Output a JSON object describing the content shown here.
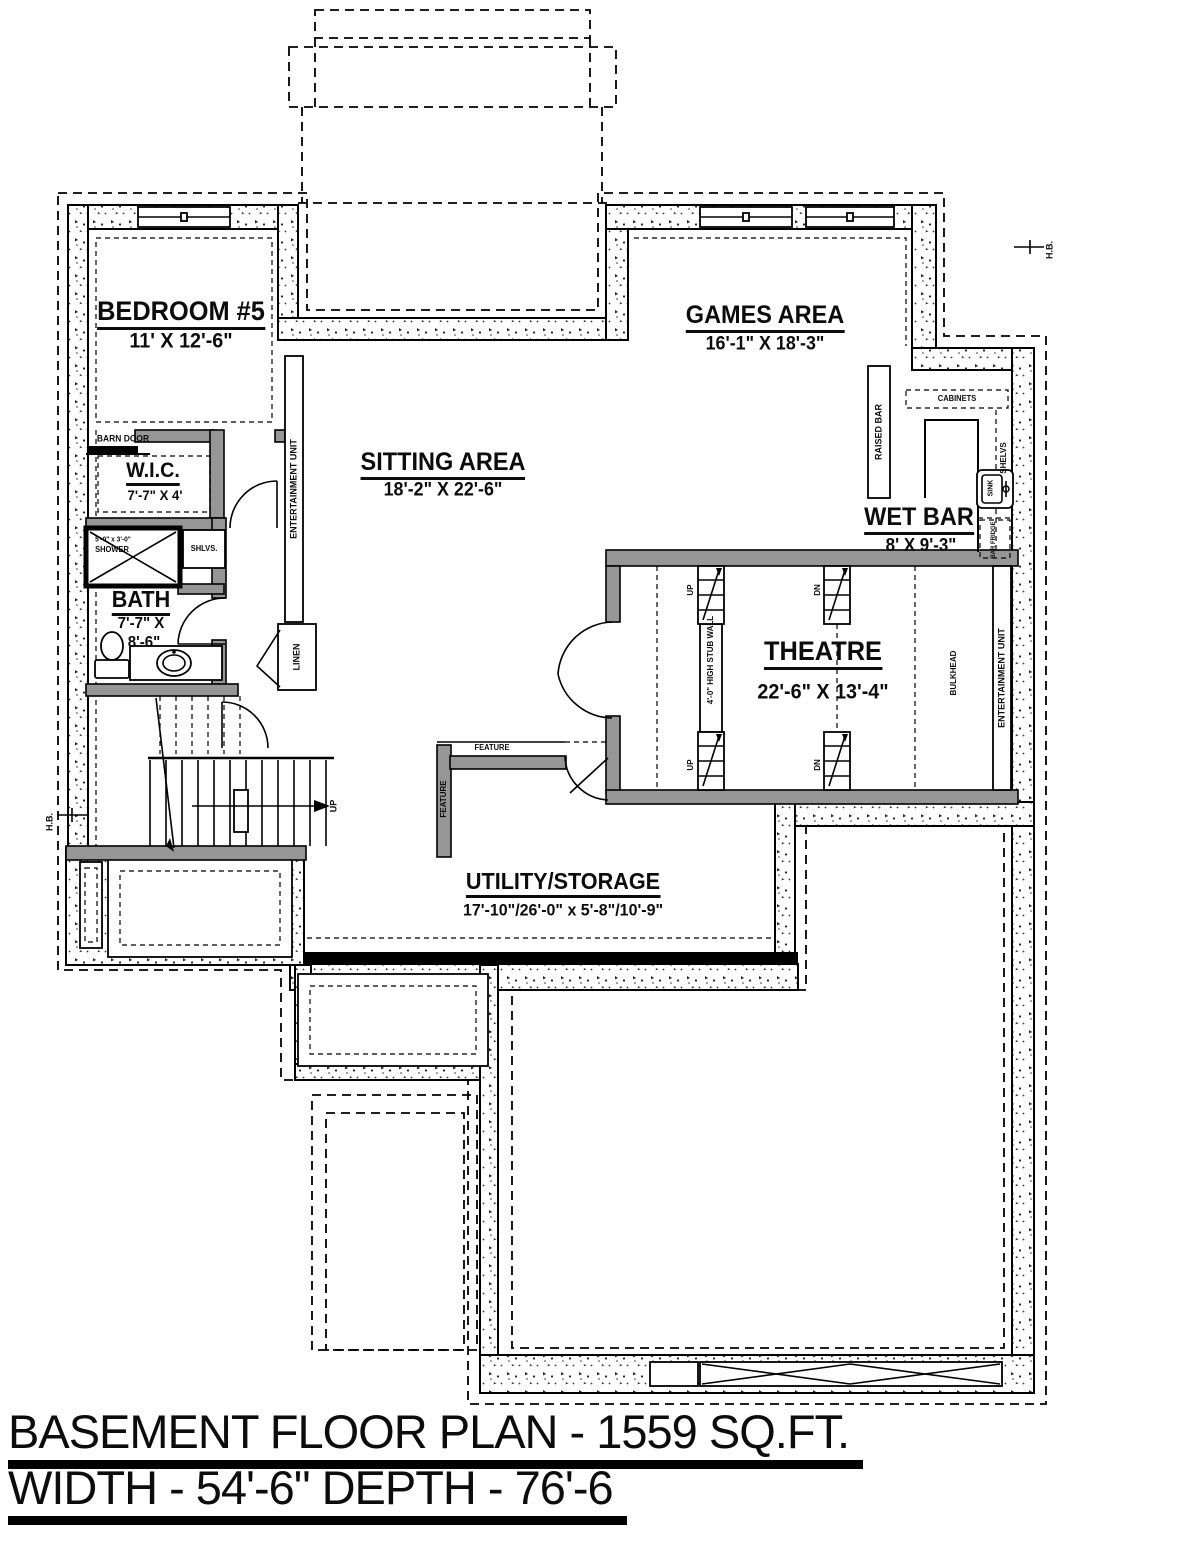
{
  "title_block": {
    "line1": "BASEMENT FLOOR PLAN - 1559 SQ.FT.",
    "line2": "WIDTH - 54'-6\" DEPTH - 76'-6"
  },
  "rooms": {
    "bedroom5": {
      "name": "BEDROOM #5",
      "dims": "11' X 12'-6\""
    },
    "sitting": {
      "name": "SITTING AREA",
      "dims": "18'-2\" X 22'-6\""
    },
    "games": {
      "name": "GAMES AREA",
      "dims": "16'-1\" X 18'-3\""
    },
    "wet_bar": {
      "name": "WET BAR",
      "dims": "8' X 9'-3\""
    },
    "theatre": {
      "name": "THEATRE",
      "dims": "22'-6\" X 13'-4\""
    },
    "wic": {
      "name": "W.I.C.",
      "dims": "7'-7\" X 4'"
    },
    "bath": {
      "name": "BATH",
      "dims_line1": "7'-7\" X",
      "dims_line2": "8'-6\""
    },
    "utility": {
      "name": "UTILITY/STORAGE",
      "dims": "17'-10\"/26'-0\" x 5'-8\"/10'-9\""
    }
  },
  "annotations": {
    "barn_door": "BARN DOOR",
    "shower_size": "5'-0\" x 3'-0\"",
    "shower": "SHOWER",
    "shelves_bath": "SHLVS.",
    "linen": "LINEN",
    "entertainment_unit_sitting": "ENTERTAINMENT UNIT",
    "entertainment_unit_theatre": "ENTERTAINMENT UNIT",
    "cabinets": "CABINETS",
    "raised_bar": "RAISED BAR",
    "shelves_bar": "SHELVS",
    "sink": "SINK",
    "bar_fridge": "BAR FRIDGE",
    "bulkhead": "BULKHEAD",
    "stub_wall": "4'-0\" HIGH STUB WALL",
    "feature_vertical": "FEATURE",
    "feature_horizontal": "FEATURE",
    "up_stairs": "UP",
    "up_theatre_left_top": "UP",
    "up_theatre_left_bottom": "UP",
    "dn_theatre_mid_top": "DN",
    "dn_theatre_mid_bottom": "DN",
    "hose_bib_right": "H.B.",
    "hose_bib_left": "H.B."
  },
  "colors": {
    "paper": "#ffffff",
    "interior_wall": "#969696",
    "line": "#000000"
  }
}
